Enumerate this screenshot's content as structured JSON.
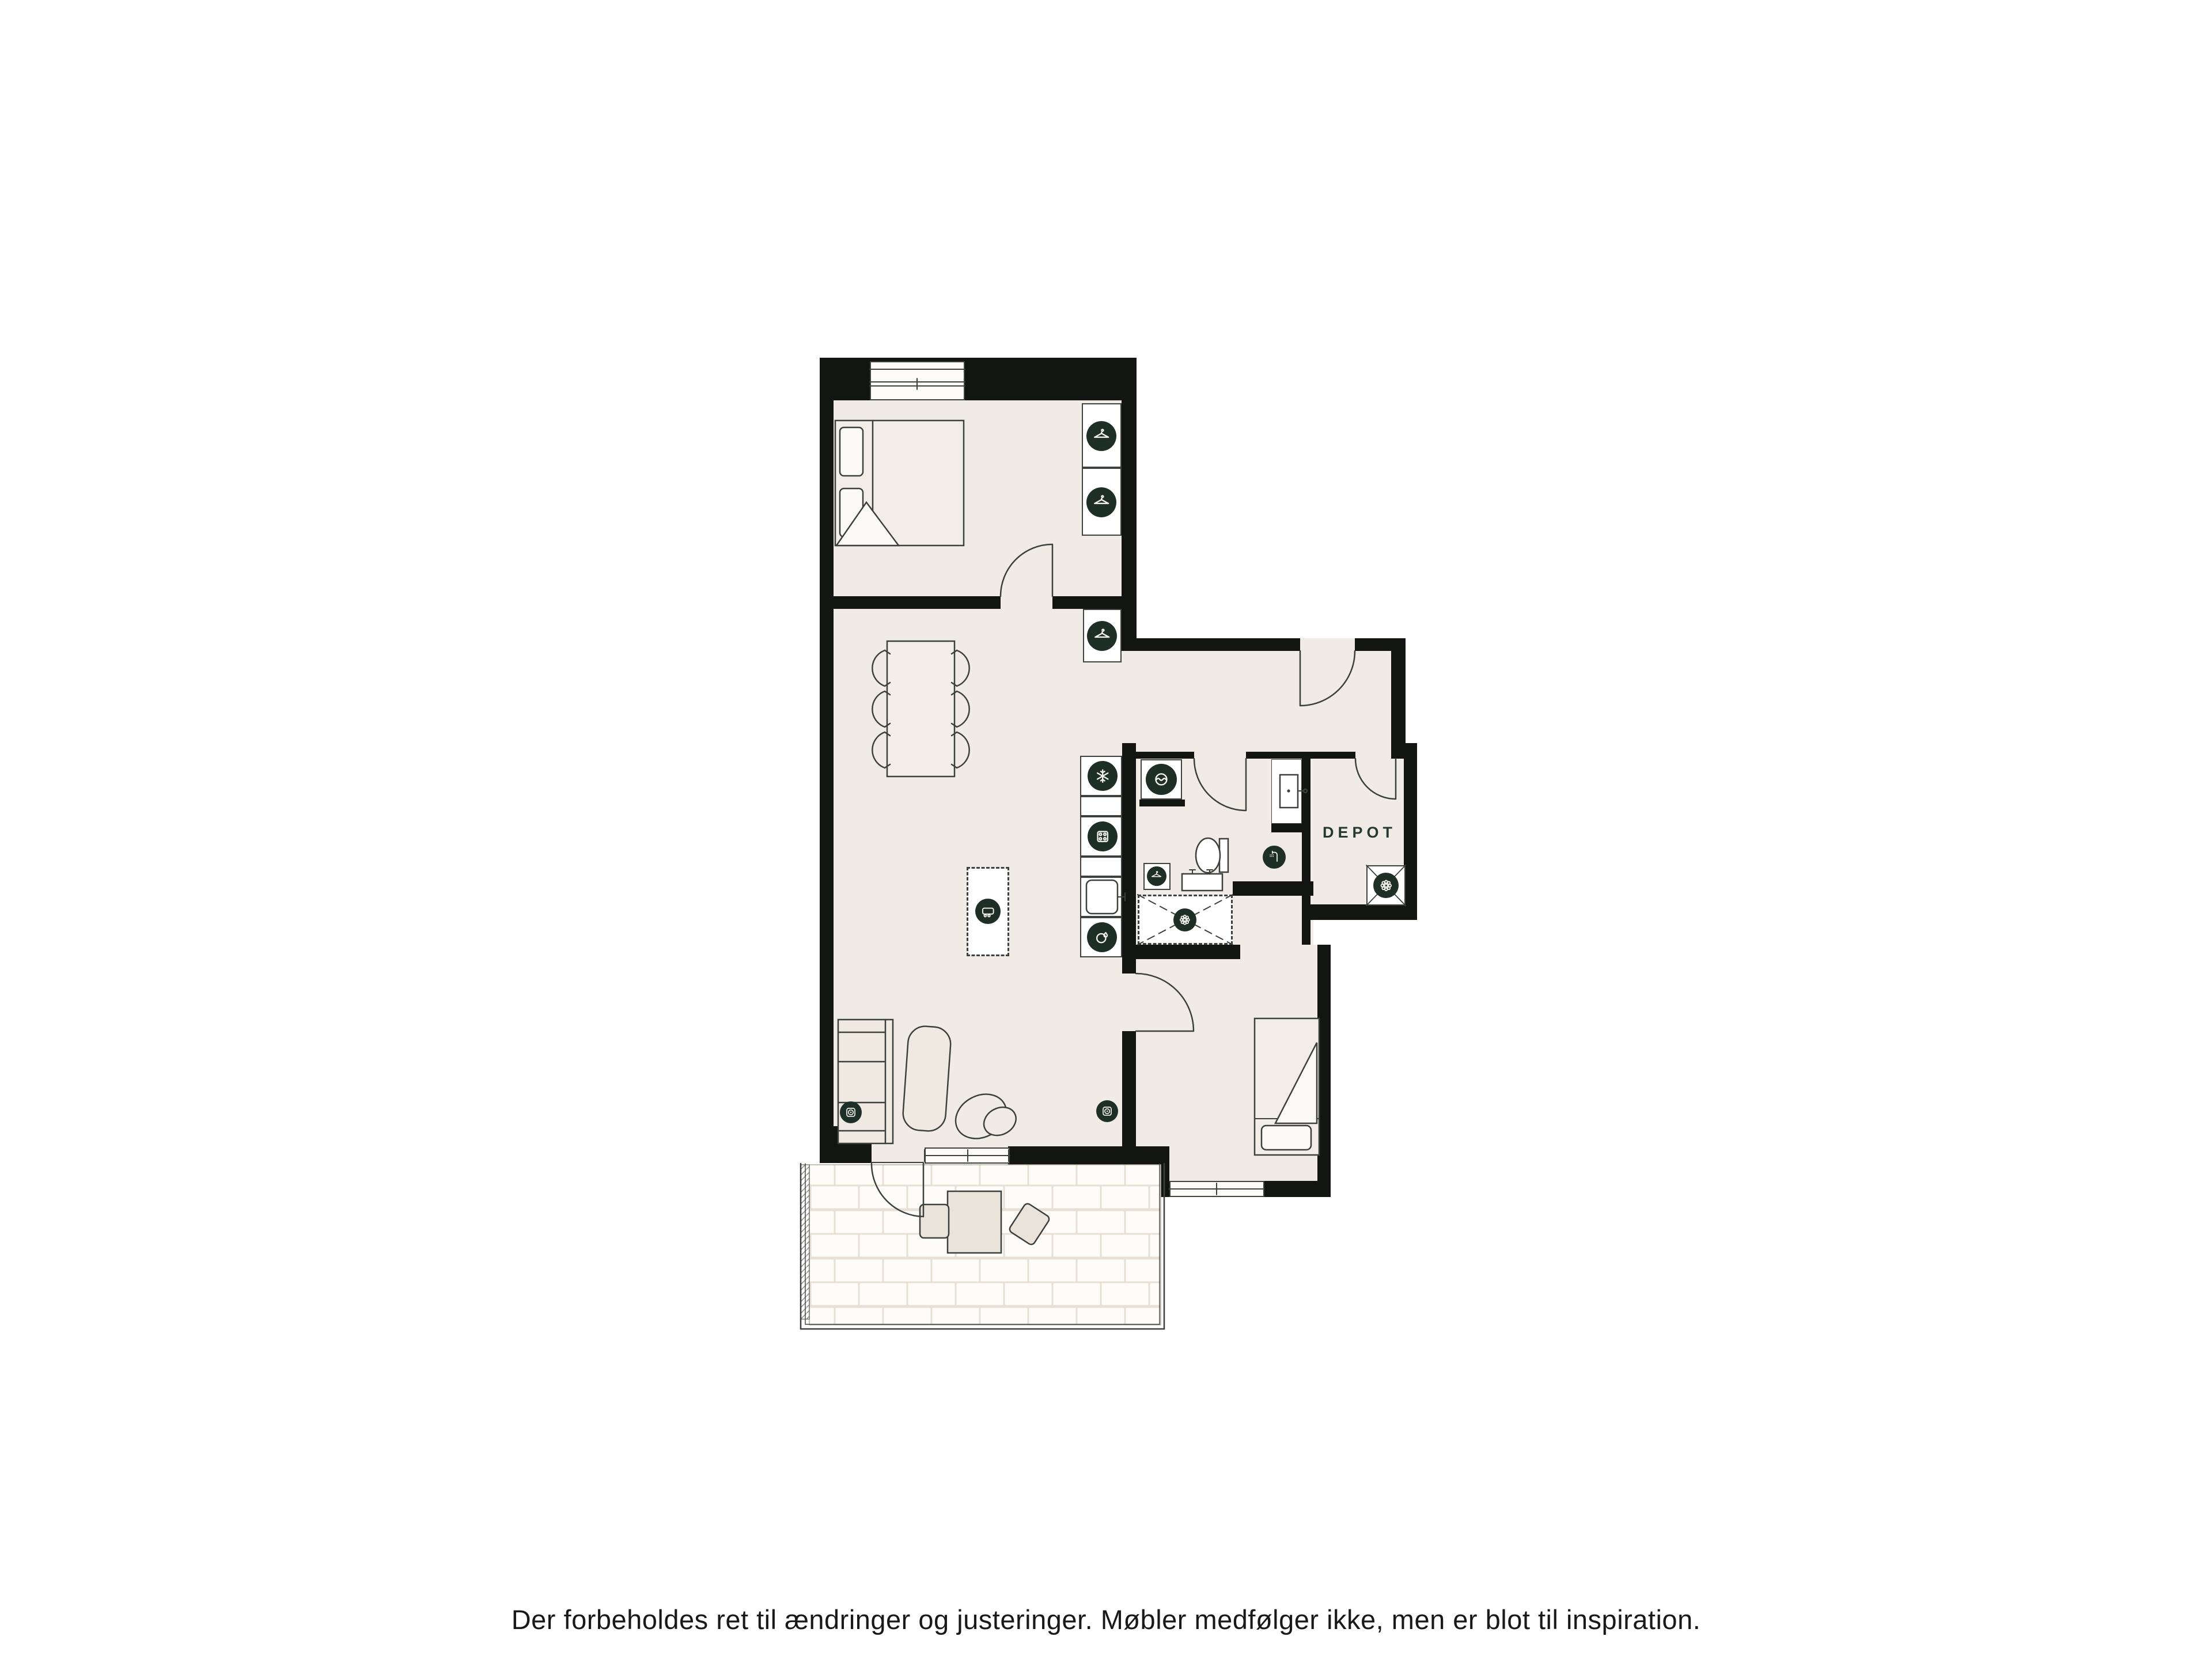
{
  "document": {
    "type": "apartment-floor-plan",
    "labels": {
      "depot": "DEPOT"
    },
    "disclaimer": "Der forbeholdes ret til ændringer og justeringer. Møbler medfølger ikke, men er blot til inspiration.",
    "colors": {
      "background": "#ffffff",
      "wall": "#131513",
      "floor": "#f0ebe4",
      "icon_badge": "#1e2f27",
      "line": "#3c403c",
      "fixture": "#ffffff",
      "furniture_fill": "#efe9e1",
      "tile_grout": "#e7e0d5"
    },
    "icons": [
      {
        "name": "wardrobe-hanger-icon",
        "glyph": "clothes-hanger",
        "count": 3
      },
      {
        "name": "towel-hanger-icon",
        "glyph": "clothes-hanger",
        "count": 1
      },
      {
        "name": "freezer-icon",
        "glyph": "snowflake",
        "count": 1
      },
      {
        "name": "hob-icon",
        "glyph": "four-burner-hob",
        "count": 1
      },
      {
        "name": "dishwasher-icon",
        "glyph": "plate-with-water-drop",
        "count": 1
      },
      {
        "name": "washing-machine-icon",
        "glyph": "drum-with-wave",
        "count": 1
      },
      {
        "name": "shower-icon",
        "glyph": "shower-head",
        "count": 1
      },
      {
        "name": "floor-drain-icon",
        "glyph": "scalloped-rosette",
        "count": 1
      },
      {
        "name": "ventilation-icon",
        "glyph": "scalloped-rosette",
        "count": 1
      },
      {
        "name": "kitchen-island-icon",
        "glyph": "trolley-on-wheels",
        "count": 1
      },
      {
        "name": "power-socket-icon",
        "glyph": "socket-outlet",
        "count": 2
      }
    ]
  }
}
